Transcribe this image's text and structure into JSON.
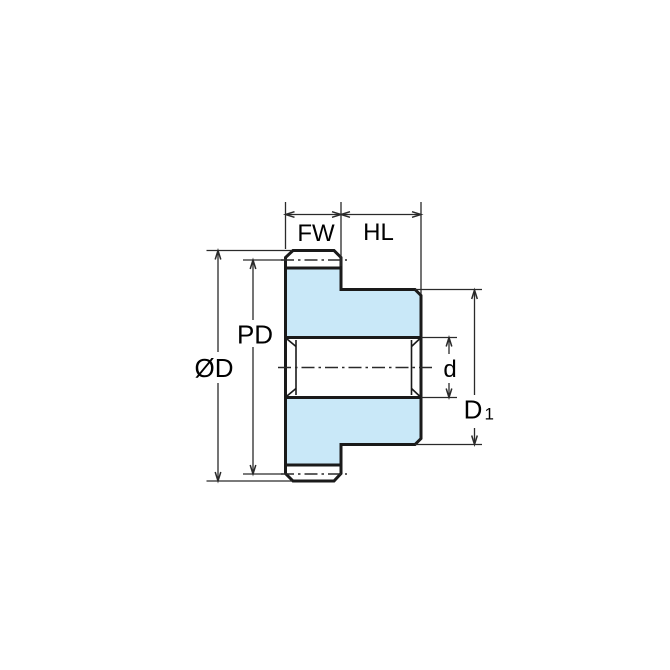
{
  "diagram": {
    "type": "engineering-drawing",
    "subject": "spur gear cross-section side view with dimension callouts",
    "labels": {
      "face_width": "FW",
      "hub_length": "HL",
      "pitch_diameter": "PD",
      "outside_diameter": "ØD",
      "bore_diameter": "d",
      "hub_diameter_main": "D",
      "hub_diameter_sub": "1"
    },
    "colors": {
      "part_fill": "#c9e8f8",
      "tooth_fill": "#ffffff",
      "outline": "#1a1a1a",
      "dimension_lines": "#2a2a2a",
      "text": "#000000",
      "background": "#ffffff"
    }
  }
}
